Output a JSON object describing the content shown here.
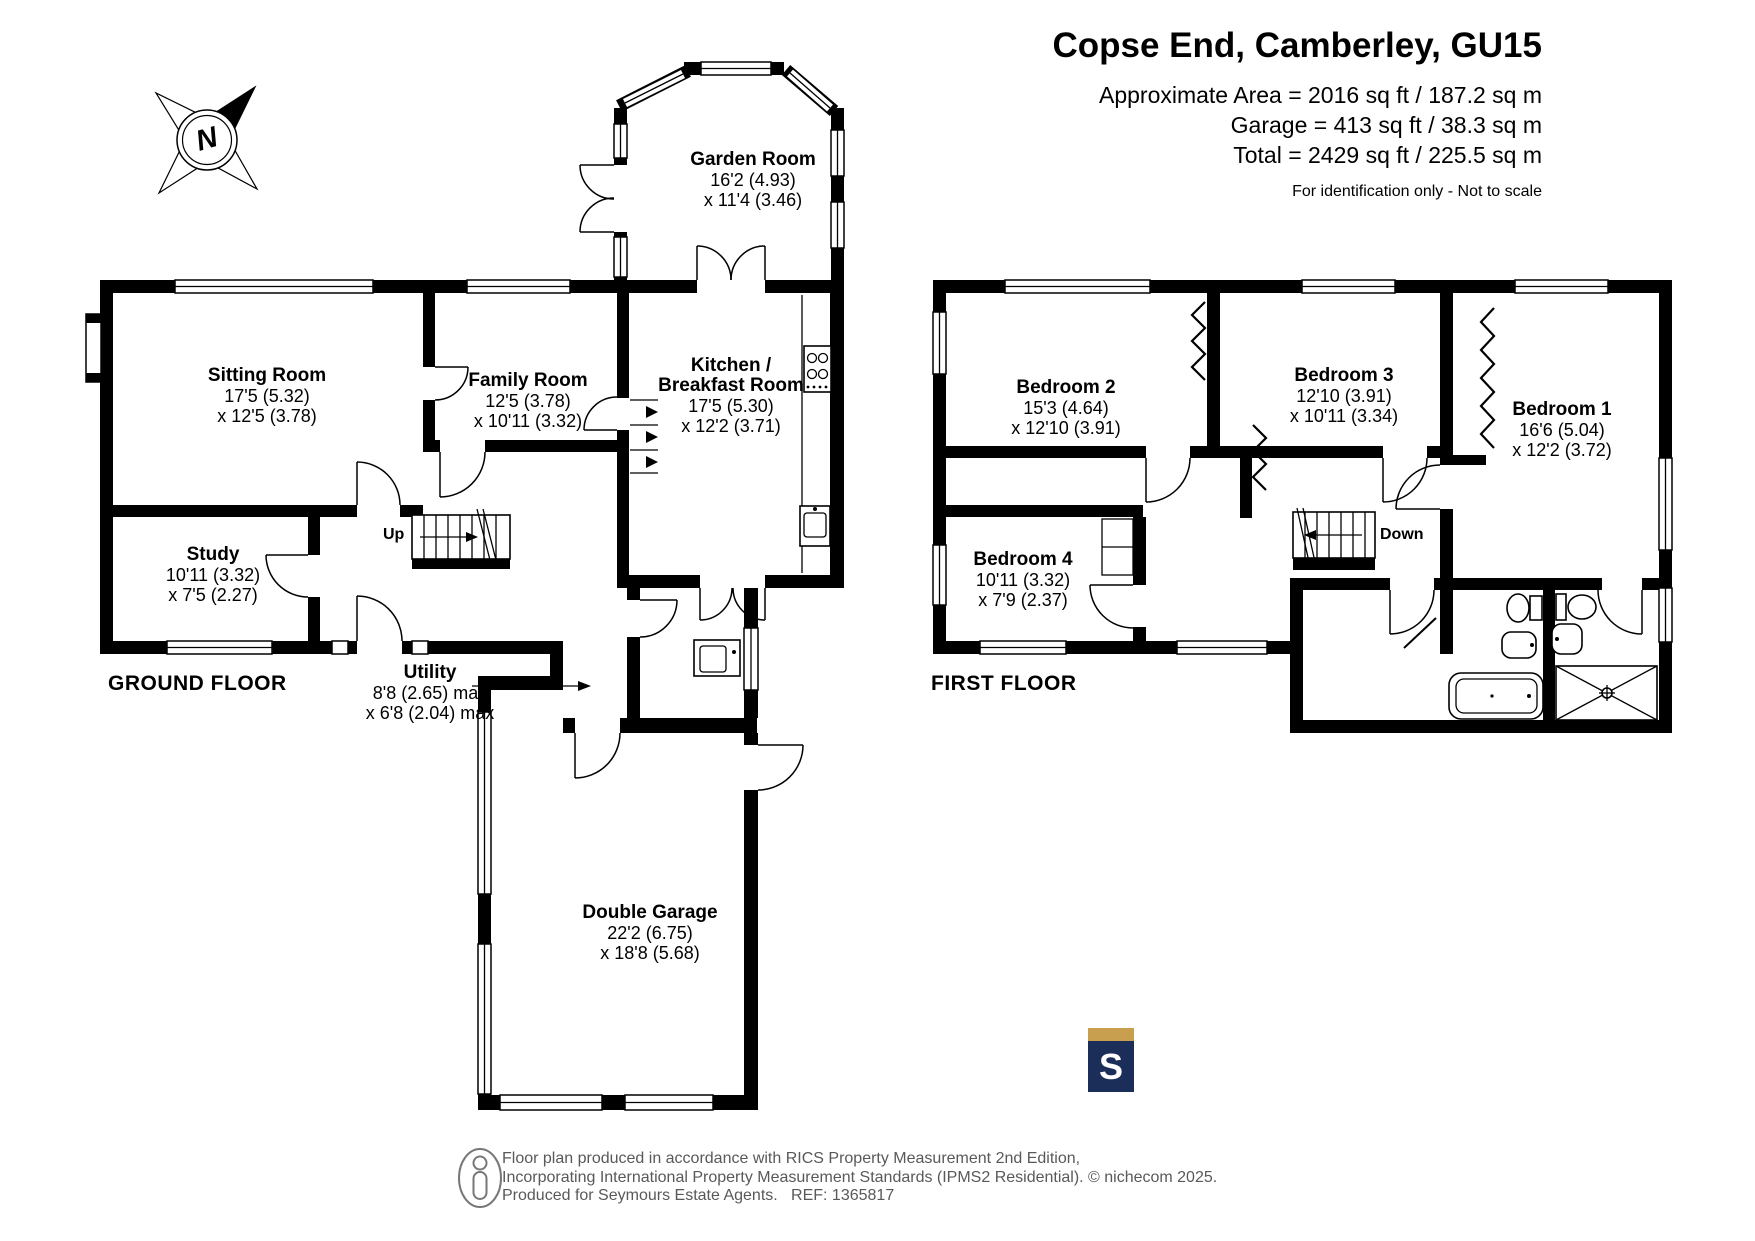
{
  "header": {
    "title": "Copse End, Camberley, GU15",
    "area_lines": [
      "Approximate Area = 2016 sq ft / 187.2 sq m",
      "Garage = 413 sq ft / 38.3 sq m",
      "Total = 2429 sq ft / 225.5 sq m"
    ],
    "disclaimer": "For identification only - Not to scale"
  },
  "compass": {
    "icon": "compass-rose-icon",
    "north_label": "N"
  },
  "ground_floor": {
    "label": "GROUND FLOOR",
    "stairs_label": "Up",
    "rooms": {
      "garden_room": {
        "name": "Garden Room",
        "dim1": "16'2 (4.93)",
        "dim2": "x 11'4 (3.46)"
      },
      "sitting_room": {
        "name": "Sitting Room",
        "dim1": "17'5 (5.32)",
        "dim2": "x 12'5 (3.78)"
      },
      "family_room": {
        "name": "Family Room",
        "dim1": "12'5 (3.78)",
        "dim2": "x 10'11 (3.32)"
      },
      "kitchen": {
        "name_line1": "Kitchen /",
        "name_line2": "Breakfast Room",
        "dim1": "17'5 (5.30)",
        "dim2": "x 12'2 (3.71)"
      },
      "study": {
        "name": "Study",
        "dim1": "10'11 (3.32)",
        "dim2": "x 7'5 (2.27)"
      },
      "utility": {
        "name": "Utility",
        "dim1": "8'8 (2.65) max",
        "dim2": "x 6'8 (2.04) max"
      },
      "double_garage": {
        "name": "Double Garage",
        "dim1": "22'2 (6.75)",
        "dim2": "x 18'8 (5.68)"
      }
    }
  },
  "first_floor": {
    "label": "FIRST FLOOR",
    "stairs_label": "Down",
    "rooms": {
      "bedroom_1": {
        "name": "Bedroom 1",
        "dim1": "16'6 (5.04)",
        "dim2": "x 12'2 (3.72)"
      },
      "bedroom_2": {
        "name": "Bedroom 2",
        "dim1": "15'3 (4.64)",
        "dim2": "x 12'10 (3.91)"
      },
      "bedroom_3": {
        "name": "Bedroom 3",
        "dim1": "12'10 (3.91)",
        "dim2": "x 10'11 (3.34)"
      },
      "bedroom_4": {
        "name": "Bedroom 4",
        "dim1": "10'11 (3.32)",
        "dim2": "x 7'9 (2.37)"
      }
    }
  },
  "footer": {
    "person_icon": "person-outline-icon",
    "line1": "Floor plan produced in accordance with RICS Property Measurement 2nd Edition,",
    "line2": "Incorporating International Property Measurement Standards (IPMS2 Residential).",
    "line3": "Produced for Seymours Estate Agents.   REF: 1365817",
    "copyright": "© nichecom 2025.",
    "agent_logo_letter": "S"
  },
  "colors": {
    "wall": "#000000",
    "logo_navy": "#1B2E5A",
    "logo_gold": "#C79F4E",
    "footer_gray": "#595959"
  }
}
